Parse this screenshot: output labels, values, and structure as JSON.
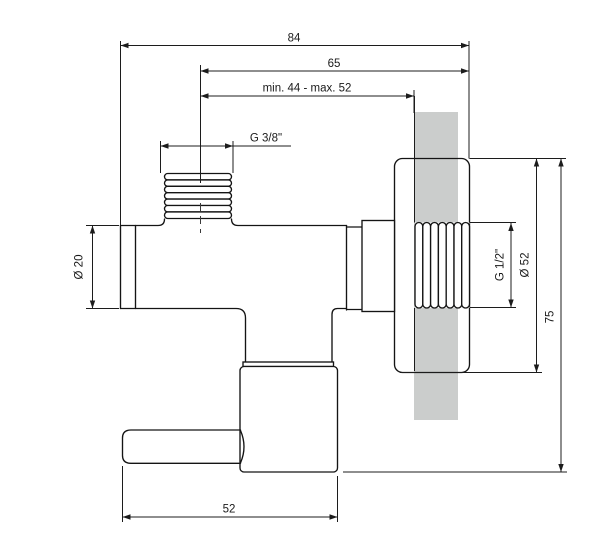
{
  "drawing": {
    "title": "Angle valve technical drawing",
    "dimensions": {
      "overall_width": "84",
      "width_to_thread_end": "65",
      "wall_distance_range": "min. 44 - max. 52",
      "top_thread": "G 3/8\"",
      "inlet_diameter": "Ø 20",
      "wall_thread": "G 1/2\"",
      "rosette_diameter": "Ø 52",
      "overall_height": "75",
      "body_width": "52"
    },
    "colors": {
      "line": "#1a1a1a",
      "wall": "#cbcdcc",
      "background": "#ffffff"
    }
  }
}
